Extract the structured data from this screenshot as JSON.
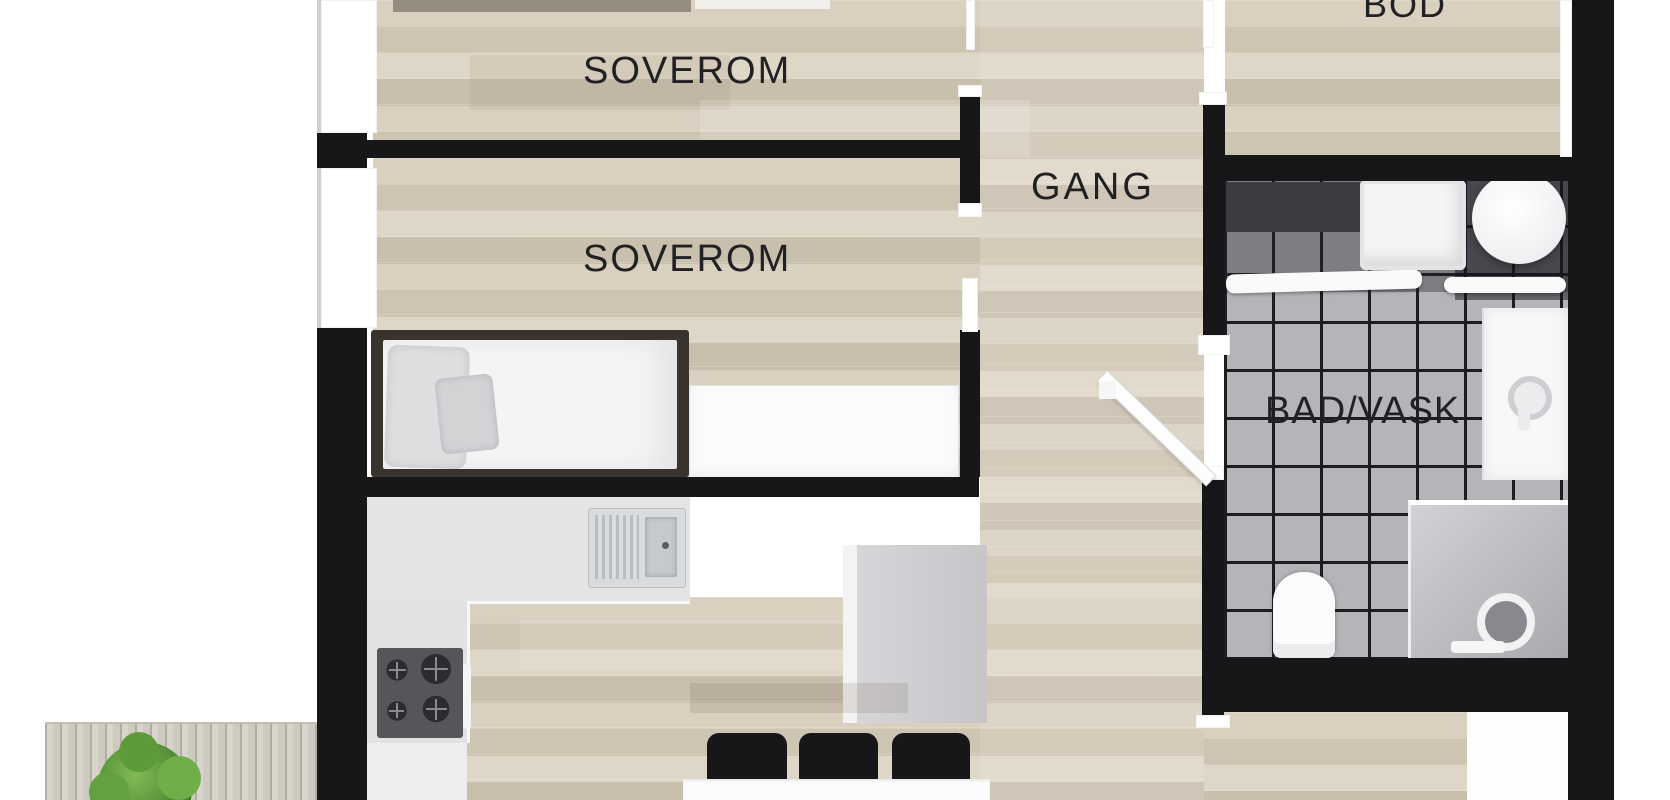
{
  "plan": {
    "type": "apartment-floor-plan",
    "rooms": [
      {
        "id": "soverom-1",
        "label": "SOVEROM"
      },
      {
        "id": "soverom-2",
        "label": "SOVEROM"
      },
      {
        "id": "gang",
        "label": "GANG"
      },
      {
        "id": "bod",
        "label": "BOD"
      },
      {
        "id": "bad-vask",
        "label": "BAD/VASK"
      }
    ],
    "fixtures": [
      "single-bed",
      "pillows",
      "dresser",
      "kitchen-counter",
      "kitchen-sink",
      "cooktop-stove",
      "kitchen-island",
      "dining-table",
      "dining-chairs",
      "washing-machine",
      "round-basin",
      "bathroom-counter",
      "wall-shelf",
      "vanity-sink",
      "toilet",
      "shower",
      "door-leaf",
      "windows",
      "outdoor-deck",
      "potted-plant"
    ],
    "palette": {
      "wall": "#17171a",
      "wood_floor": "#d6cdbd",
      "tile_floor": "#b5b5b9",
      "tile_grout": "#1e1e22",
      "kitchen_floor": "#ededee",
      "deck_wood": "#d7d3ca",
      "plant_green": "#5d9a3a",
      "furniture_white": "#f4f4f6",
      "chair_black": "#17171a"
    }
  }
}
